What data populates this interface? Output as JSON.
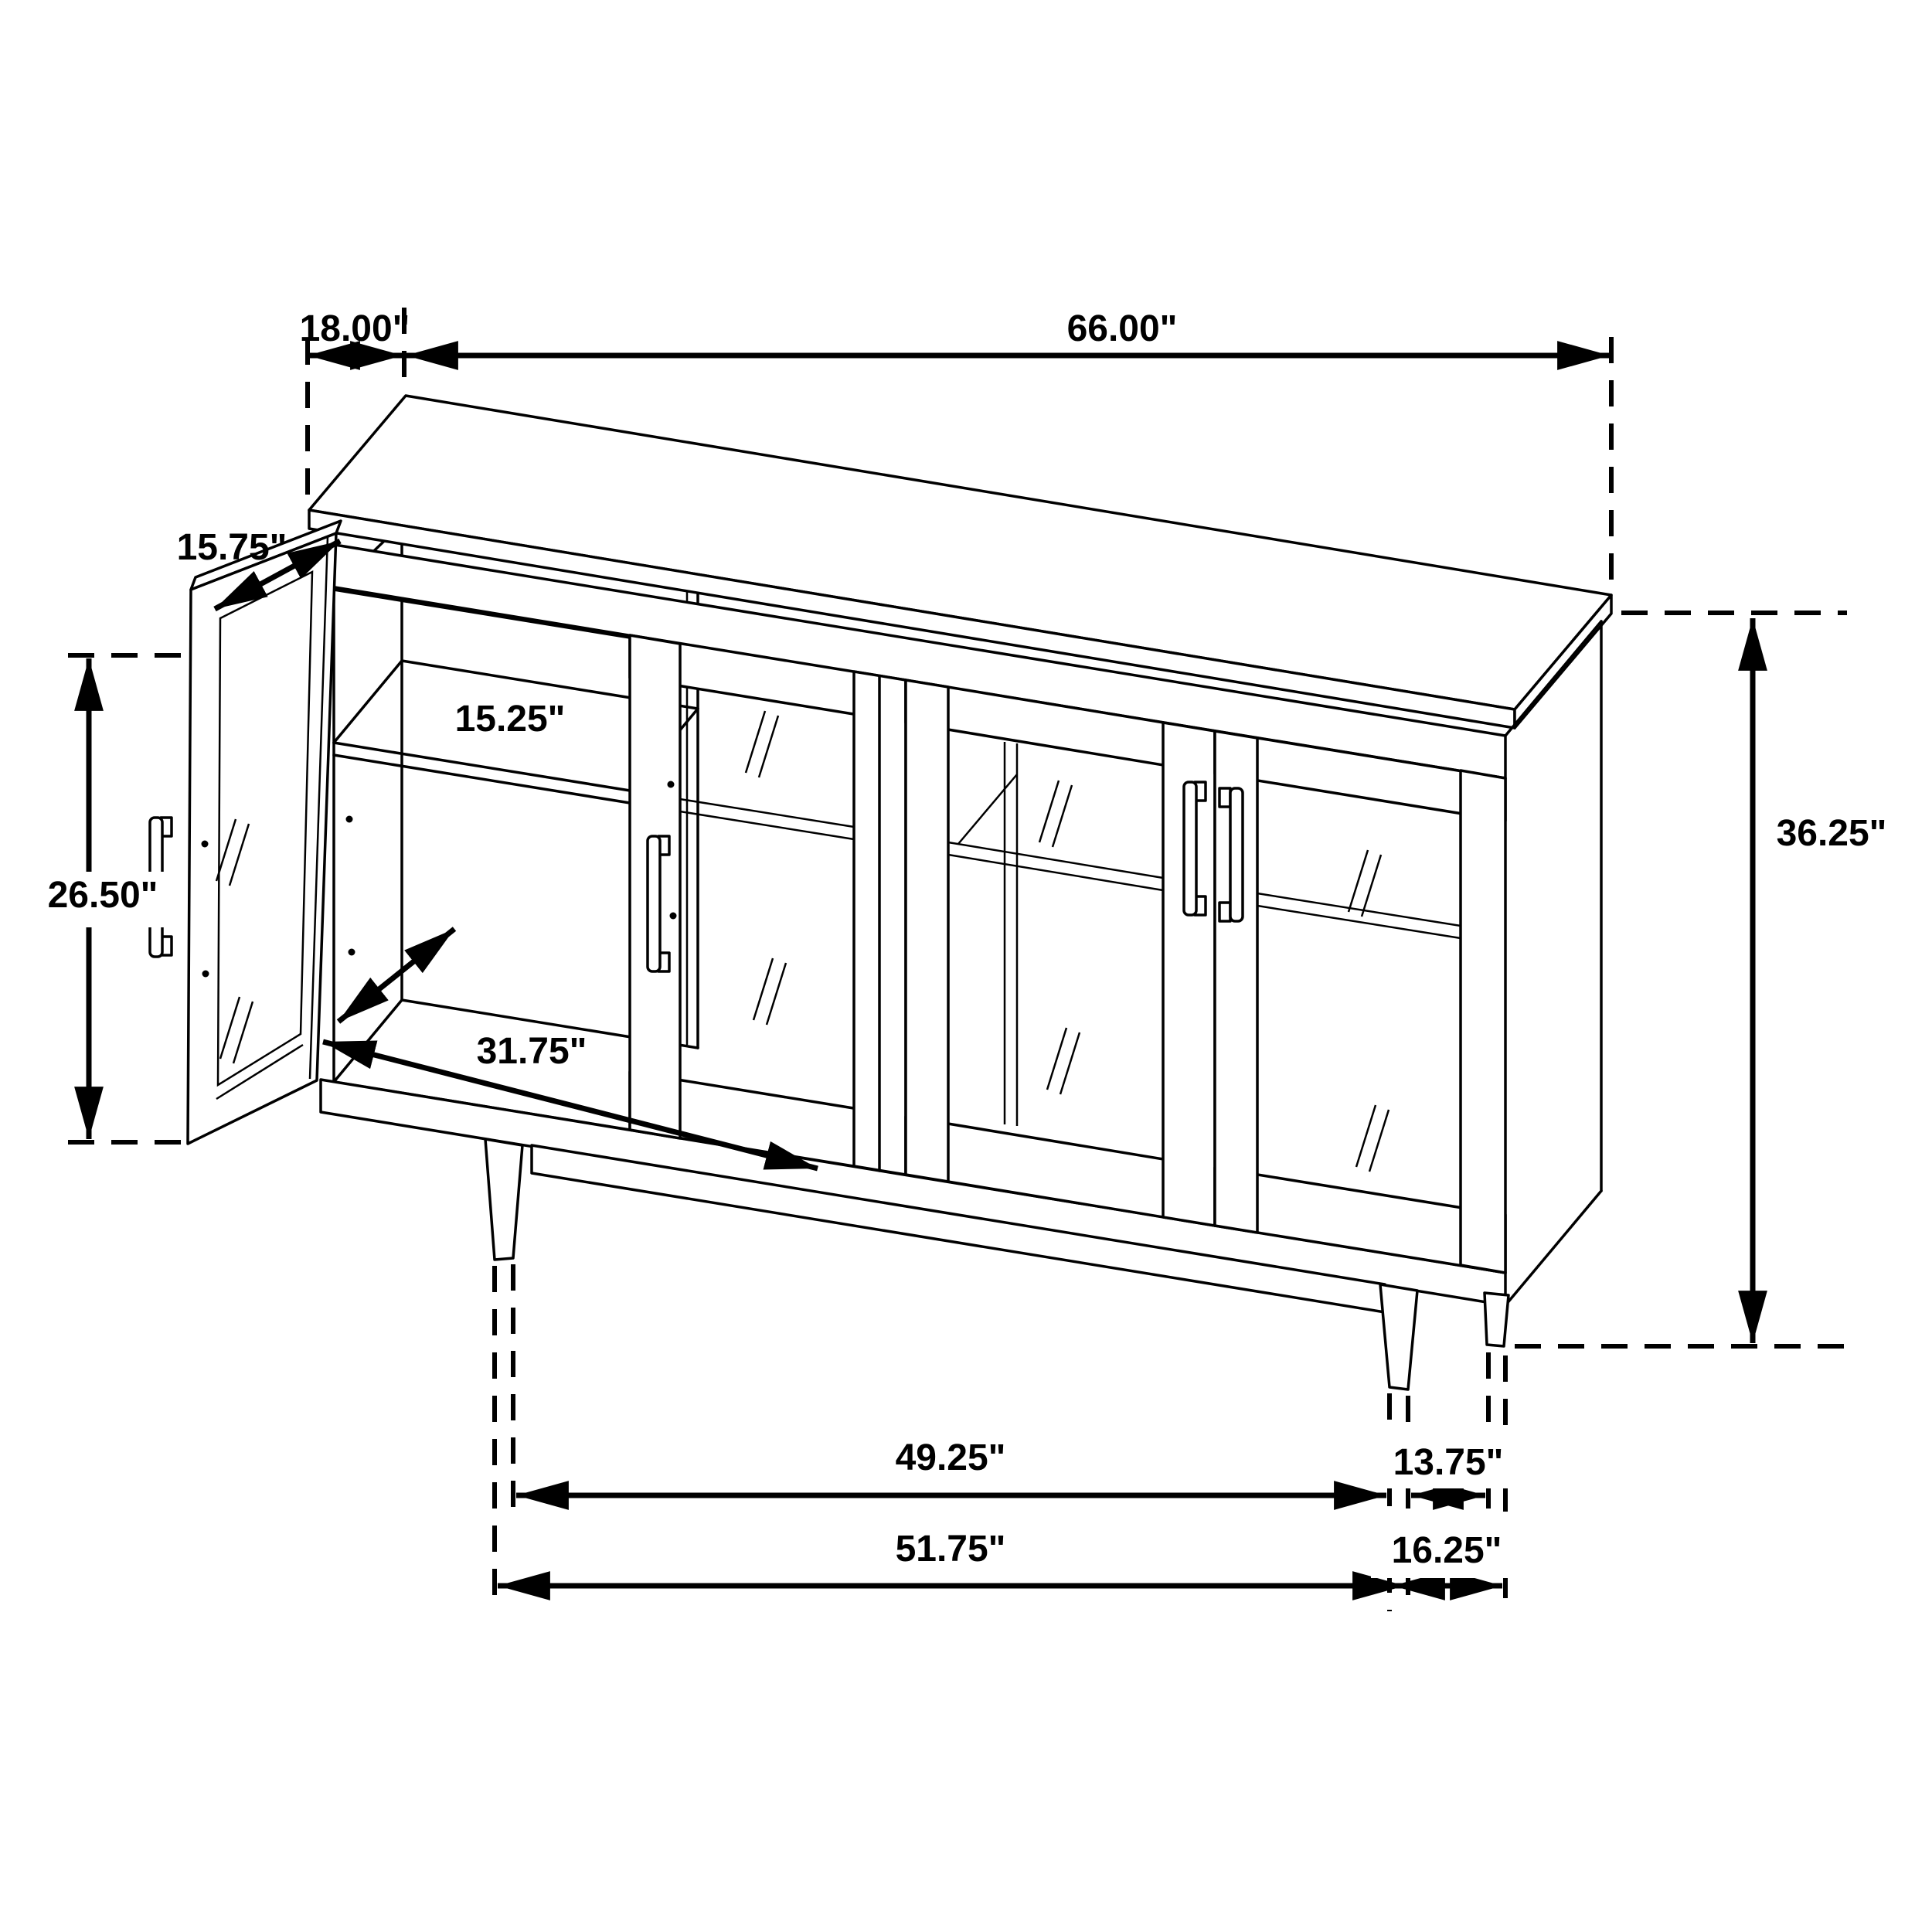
{
  "diagram": {
    "type": "furniture-dimension-drawing",
    "subject": "sideboard-cabinet-with-glass-doors-isometric-view",
    "unit": "inches",
    "style": {
      "line_color": "#000000",
      "background_color": "#ffffff"
    },
    "dims": {
      "top_depth": "18.00\"",
      "top_width": "66.00\"",
      "door_width": "15.75\"",
      "shelf_depth": "15.25\"",
      "door_height": "26.50\"",
      "interior_diagonal": "31.75\"",
      "total_height": "36.25\"",
      "front_leg_span_inner": "49.25\"",
      "front_leg_span_outer": "51.75\"",
      "side_leg_span_inner": "13.75\"",
      "side_leg_span_outer": "16.25\""
    }
  }
}
